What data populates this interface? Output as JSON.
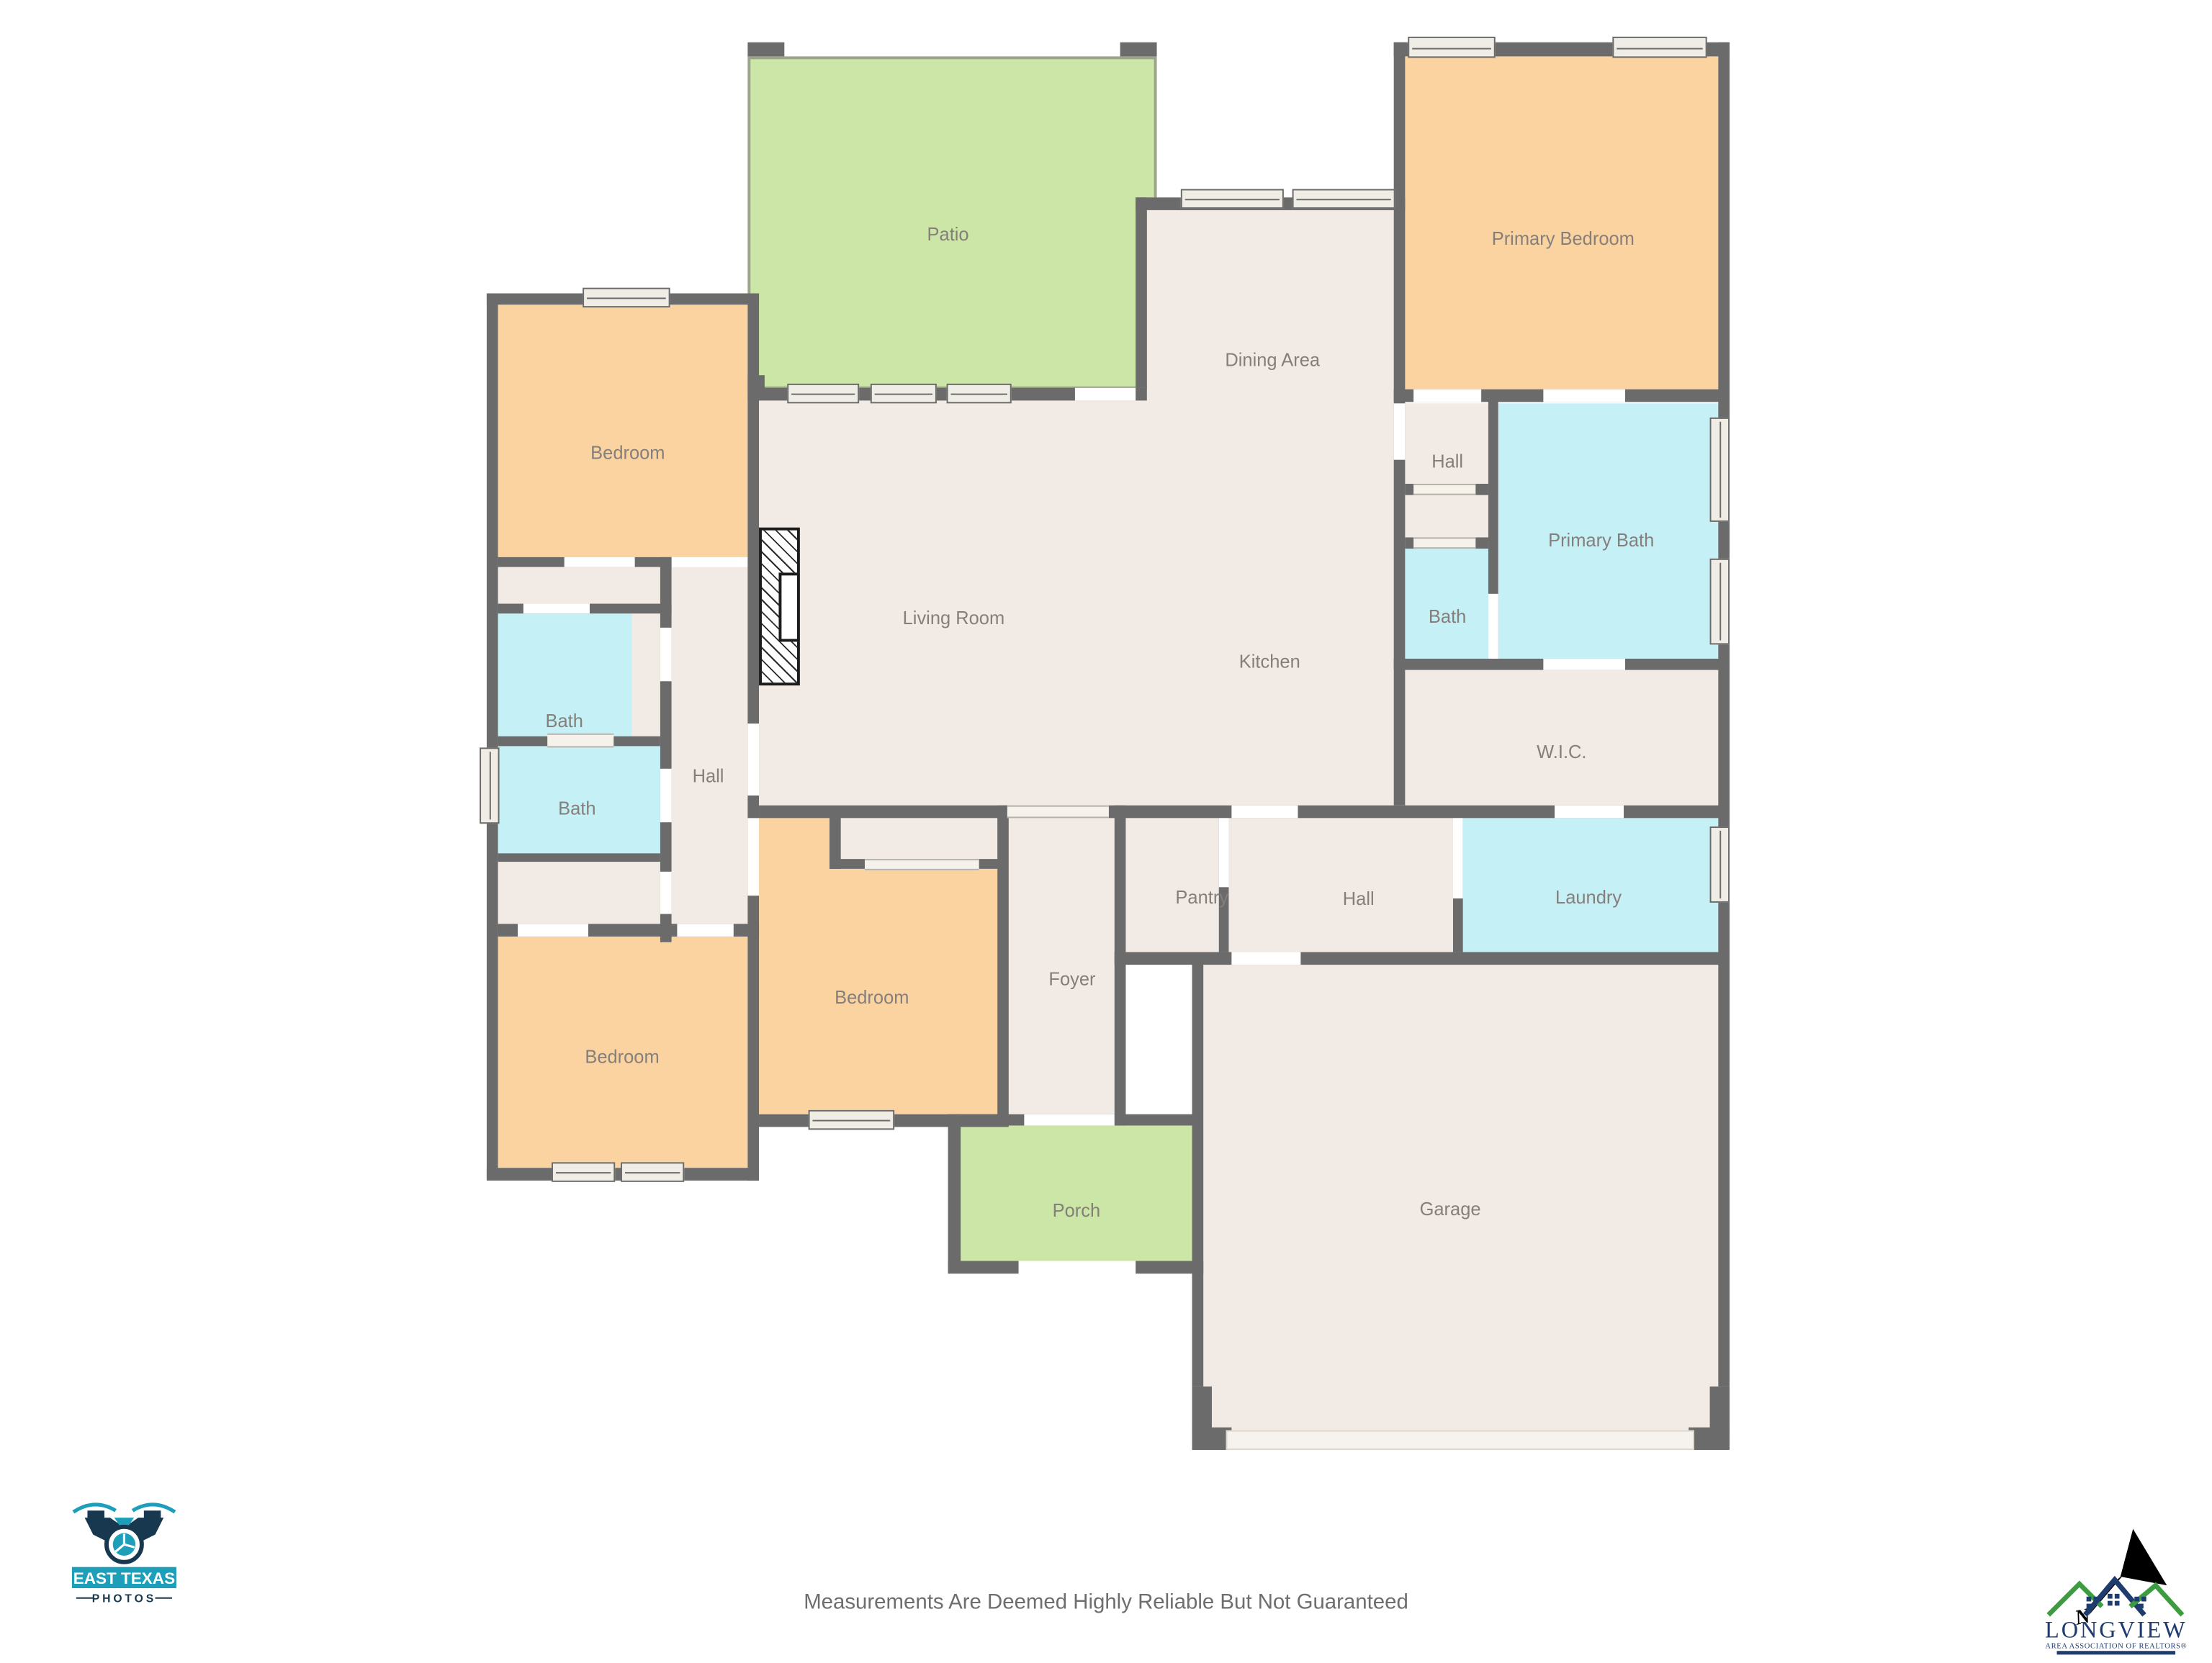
{
  "page": {
    "footer_disclaimer": "Measurements Are Deemed Highly Reliable But Not Guaranteed"
  },
  "palette": {
    "wall": "#6B6B6B",
    "beige": "#F2EBE5",
    "orange": "#FAD3A1",
    "cyan": "#C5F0F6",
    "green": "#CBE6A6",
    "window_fill": "#F0EDE6",
    "opening": "#F5F1EB",
    "garage_door": "#F6F2ED",
    "label": "#857F7C",
    "footer_text": "#6E6E6E",
    "patio_border": "#9BA58E",
    "hatch": "#2A2A2A",
    "teal": "#1D9FBA",
    "navy": "#17384F",
    "lv_green": "#3E9C40",
    "lv_navy": "#1E3C6E"
  },
  "rooms": [
    {
      "name": "patio",
      "label": "Patio"
    },
    {
      "name": "primary-bedroom",
      "label": "Primary Bedroom"
    },
    {
      "name": "dining-area",
      "label": "Dining Area"
    },
    {
      "name": "bedroom-top-left",
      "label": "Bedroom"
    },
    {
      "name": "hall-right-small",
      "label": "Hall"
    },
    {
      "name": "primary-bath",
      "label": "Primary Bath"
    },
    {
      "name": "living-room",
      "label": "Living Room"
    },
    {
      "name": "bath-right-small",
      "label": "Bath"
    },
    {
      "name": "kitchen",
      "label": "Kitchen"
    },
    {
      "name": "bath-left-upper",
      "label": "Bath"
    },
    {
      "name": "wic",
      "label": "W.I.C."
    },
    {
      "name": "hall-left",
      "label": "Hall"
    },
    {
      "name": "bath-left-lower",
      "label": "Bath"
    },
    {
      "name": "pantry",
      "label": "Pantry"
    },
    {
      "name": "hall-bottom",
      "label": "Hall"
    },
    {
      "name": "laundry",
      "label": "Laundry"
    },
    {
      "name": "bedroom-bottom-left",
      "label": "Bedroom"
    },
    {
      "name": "bedroom-center",
      "label": "Bedroom"
    },
    {
      "name": "foyer",
      "label": "Foyer"
    },
    {
      "name": "porch",
      "label": "Porch"
    },
    {
      "name": "garage",
      "label": "Garage"
    }
  ],
  "logos": {
    "east_texas": {
      "title": "EAST TEXAS",
      "subtitle": "PHOTOS"
    },
    "longview": {
      "name": "LONGVIEW",
      "tagline": "AREA ASSOCIATION OF REALTORS®",
      "north_letter": "N"
    }
  }
}
